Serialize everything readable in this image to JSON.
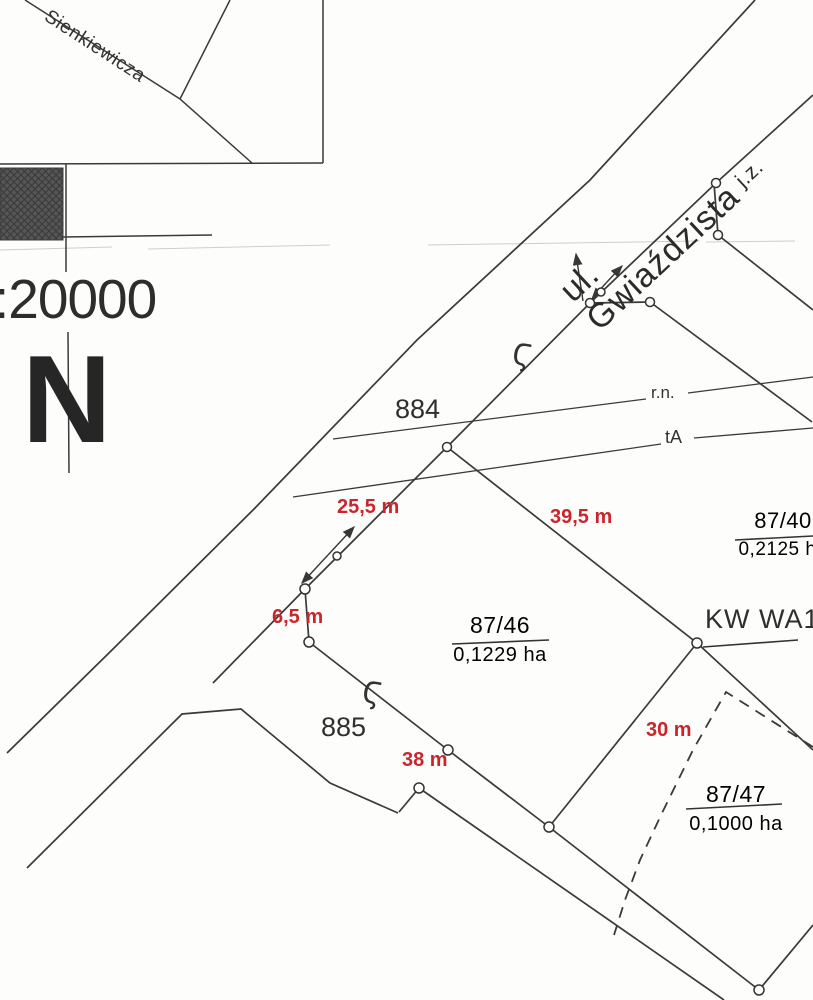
{
  "map": {
    "type": "cadastral-survey-scan",
    "colors": {
      "ink": "#383838",
      "red": "#c9252b",
      "paper": "#fdfdfc",
      "hatch": "#565656"
    },
    "legend": {
      "scale": ":20000",
      "north": "N"
    },
    "streets": {
      "main": "ul. Gwiaździsta",
      "main_suffix": "j.z.",
      "secondary": "Sienkiewicza"
    },
    "parcels": {
      "p884": "884",
      "p885": "885",
      "p87_46_num": "87/46",
      "p87_46_area": "0,1229 ha",
      "p87_47_num": "87/47",
      "p87_47_area": "0,1000 ha",
      "p87_40_num": "87/40",
      "p87_40_area": "0,2125 ha",
      "kw": "KW WA1P"
    },
    "measurements": {
      "m25_5": "25,5 m",
      "m39_5": "39,5 m",
      "m6_5": "6,5 m",
      "m38": "38 m",
      "m30": "30 m"
    },
    "utilities": {
      "rn": "r.n.",
      "ta": "tA"
    },
    "symbols": {
      "marker": "Ϛ"
    }
  }
}
